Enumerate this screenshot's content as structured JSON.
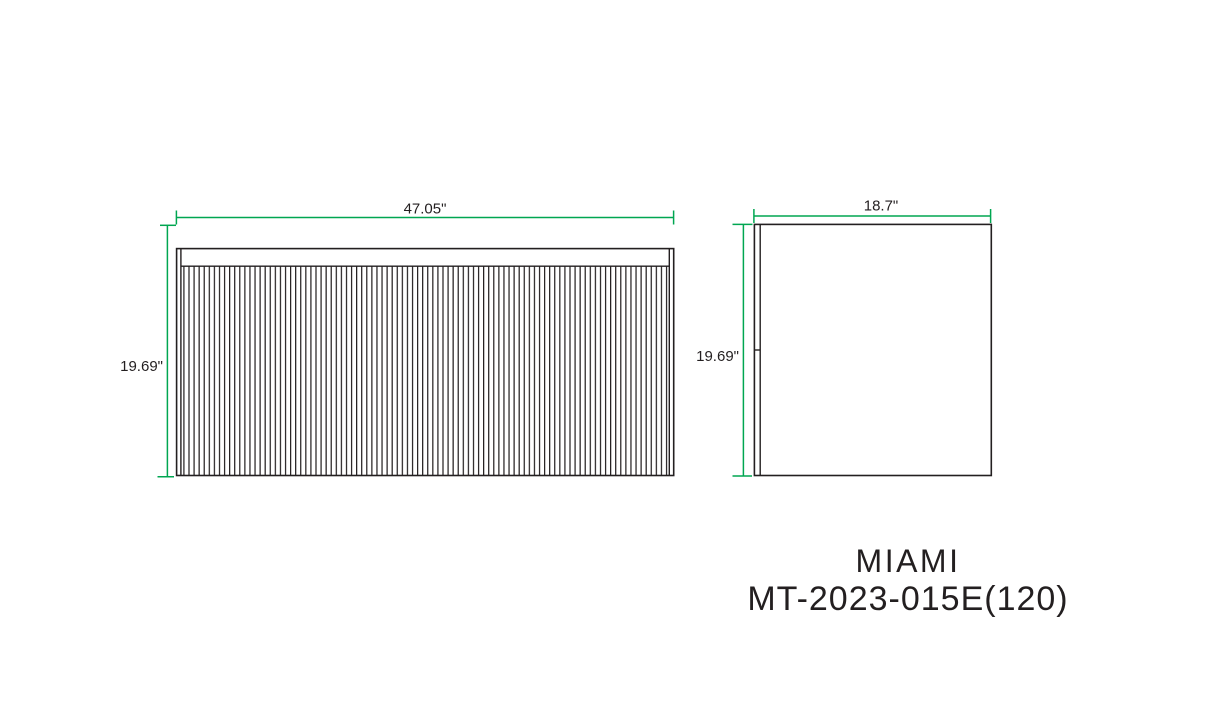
{
  "title": {
    "series": "MIAMI",
    "model": "MT-2023-015E(120)"
  },
  "views": {
    "front": {
      "width_label": "47.05\"",
      "height_label": "19.69\""
    },
    "side": {
      "width_label": "18.7\"",
      "height_label": "19.69\""
    }
  },
  "colors": {
    "dimension_line": "#00A651",
    "drawing_line": "#231F20",
    "background": "#FFFFFF"
  }
}
